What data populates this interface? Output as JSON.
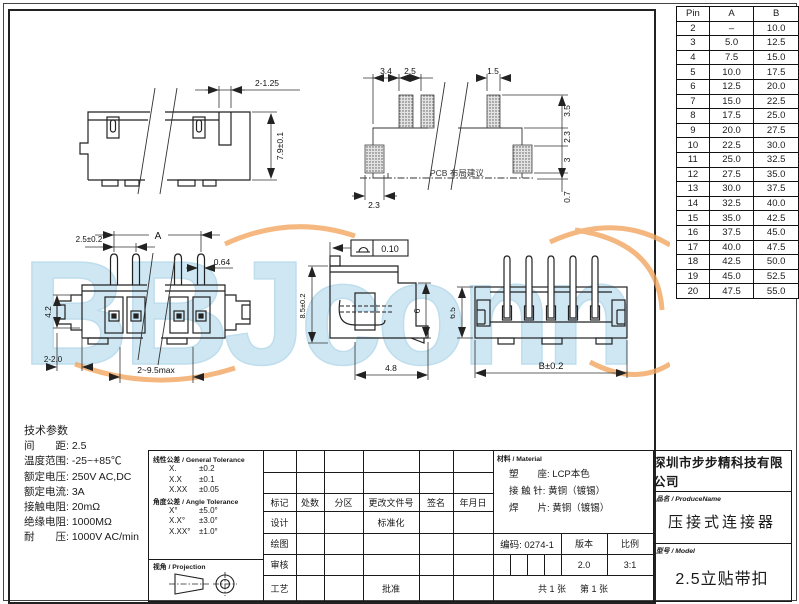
{
  "colors": {
    "line": "#1a1a1a",
    "watermark_blue": "#bedff0",
    "watermark_orange": "#f2a661"
  },
  "watermark": {
    "text": "BBJconn"
  },
  "pin_table": {
    "headers": [
      "Pin",
      "A",
      "B"
    ],
    "rows": [
      {
        "pin": "2",
        "a": "–",
        "b": "10.0"
      },
      {
        "pin": "3",
        "a": "5.0",
        "b": "12.5"
      },
      {
        "pin": "4",
        "a": "7.5",
        "b": "15.0"
      },
      {
        "pin": "5",
        "a": "10.0",
        "b": "17.5"
      },
      {
        "pin": "6",
        "a": "12.5",
        "b": "20.0"
      },
      {
        "pin": "7",
        "a": "15.0",
        "b": "22.5"
      },
      {
        "pin": "8",
        "a": "17.5",
        "b": "25.0"
      },
      {
        "pin": "9",
        "a": "20.0",
        "b": "27.5"
      },
      {
        "pin": "10",
        "a": "22.5",
        "b": "30.0"
      },
      {
        "pin": "11",
        "a": "25.0",
        "b": "32.5"
      },
      {
        "pin": "12",
        "a": "27.5",
        "b": "35.0"
      },
      {
        "pin": "13",
        "a": "30.0",
        "b": "37.5"
      },
      {
        "pin": "14",
        "a": "32.5",
        "b": "40.0"
      },
      {
        "pin": "15",
        "a": "35.0",
        "b": "42.5"
      },
      {
        "pin": "16",
        "a": "37.5",
        "b": "45.0"
      },
      {
        "pin": "17",
        "a": "40.0",
        "b": "47.5"
      },
      {
        "pin": "18",
        "a": "42.5",
        "b": "50.0"
      },
      {
        "pin": "19",
        "a": "45.0",
        "b": "52.5"
      },
      {
        "pin": "20",
        "a": "47.5",
        "b": "55.0"
      }
    ]
  },
  "drawings": {
    "side_view": {
      "dim_tab": "2-1.25",
      "dim_height": "7.9±0.1"
    },
    "pcb_layout": {
      "note": "PCB 布局建议",
      "dim_a": "3.4",
      "dim_b": "2.5",
      "dim_c": "1.5",
      "dim_d": "3.5",
      "dim_e": "2.3",
      "dim_f": "3",
      "dim_g": "0.7",
      "dim_h": "2.3"
    },
    "front_view": {
      "dim_pitch": "2.5±0.2",
      "dim_a": "A",
      "dim_pin_w": "0.64",
      "dim_body_h": "4.2",
      "dim_feet": "2-2.0",
      "dim_span": "2~9.5max"
    },
    "side_view_2": {
      "flatness": "0.10",
      "dim_h": "8.5±0.2",
      "dim_inner_h": "6",
      "dim_w": "4.8"
    },
    "rear_view": {
      "dim_h": "6.5",
      "dim_b": "B±0.2"
    }
  },
  "tech_params": {
    "title": "技术参数",
    "items": [
      {
        "label": "间　　距:",
        "value": "2.5"
      },
      {
        "label": "温度范围:",
        "value": "-25~+85℃"
      },
      {
        "label": "额定电压:",
        "value": "250V AC,DC"
      },
      {
        "label": "额定电流:",
        "value": "3A"
      },
      {
        "label": "接触电阻:",
        "value": "20mΩ"
      },
      {
        "label": "绝缘电阻:",
        "value": "1000MΩ"
      },
      {
        "label": "耐　　压:",
        "value": "1000V AC/min"
      }
    ]
  },
  "tolerance": {
    "linear_title": "线性公差 / General Tolerance",
    "linear": [
      {
        "k": "X.",
        "v": "±0.2"
      },
      {
        "k": "X.X",
        "v": "±0.1"
      },
      {
        "k": "X.XX",
        "v": "±0.05"
      }
    ],
    "angle_title": "角度公差 / Angle Tolerance",
    "angle": [
      {
        "k": "X°",
        "v": "±5.0°"
      },
      {
        "k": "X.X°",
        "v": "±3.0°"
      },
      {
        "k": "X.XX°",
        "v": "±1.0°"
      }
    ],
    "projection_title": "视角 / Projection"
  },
  "titleblock": {
    "rev_headers": [
      "标记",
      "处数",
      "分区",
      "更改文件号",
      "签名",
      "年月日"
    ],
    "design": "设计",
    "drawn": "绘图",
    "check": "审核",
    "process": "工艺",
    "standard": "标准化",
    "approve": "批准",
    "code_label": "编码: 0274-1",
    "version_label": "版本",
    "scale_label": "比例",
    "version": "2.0",
    "scale": "3:1",
    "sheet_total": "共 1 张",
    "sheet_no": "第 1 张"
  },
  "material": {
    "title": "材料 / Material",
    "items": [
      {
        "label": "塑　　座:",
        "value": "LCP本色"
      },
      {
        "label": "接 触 针:",
        "value": "黄铜（镀锡）"
      },
      {
        "label": "焊　　片:",
        "value": "黄铜（镀锡）"
      }
    ]
  },
  "company": {
    "name": "深圳市步步精科技有限公司"
  },
  "product": {
    "label": "品名 / ProduceName",
    "name": "压接式连接器"
  },
  "model": {
    "label": "型号 / Model",
    "name": "2.5立贴带扣"
  }
}
